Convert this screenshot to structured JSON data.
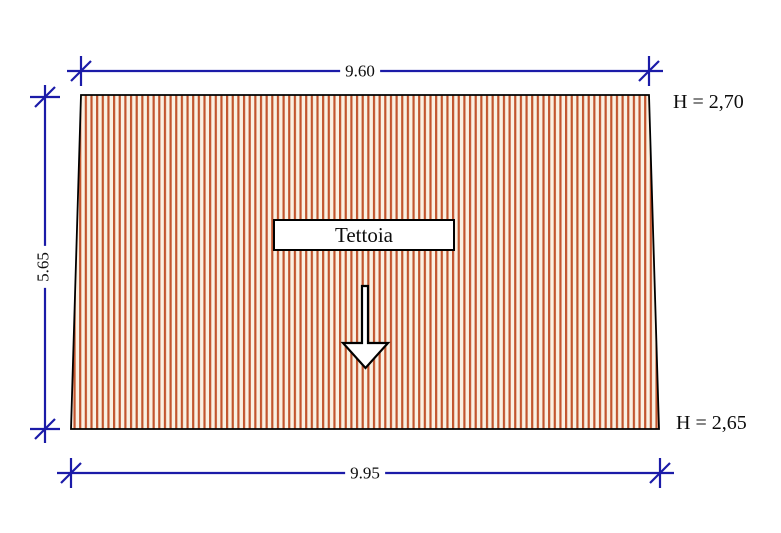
{
  "drawing": {
    "label_box": {
      "text": "Tettoia"
    },
    "dimensions": {
      "top": "9.60",
      "bottom": "9.95",
      "left": "5.65"
    },
    "heights": {
      "top_right": "H = 2,70",
      "bottom_right": "H = 2,65"
    },
    "colors": {
      "dimension_blue": "#1b1ba8",
      "hatch_orange": "#c2552e",
      "hatch_background": "#faf1e3",
      "outline_black": "#000000",
      "page_background": "#ffffff"
    },
    "icons": {
      "down_arrow": "hollow-down-arrow"
    }
  }
}
